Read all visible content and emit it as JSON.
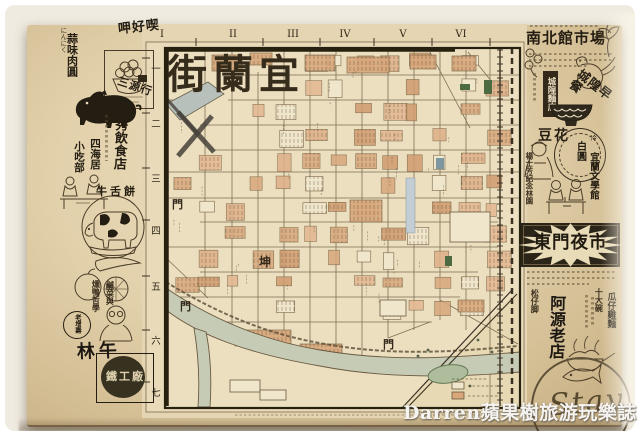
{
  "photo": {
    "watermark": "Darren蘋果樹旅游玩樂誌"
  },
  "map": {
    "title": "宜蘭街",
    "title_display": "街蘭宜",
    "grid_columns": [
      "I",
      "II",
      "III",
      "IV",
      "V",
      "VI"
    ],
    "grid_rows": [
      "一",
      "二",
      "三",
      "四",
      "五",
      "六",
      "七"
    ],
    "gate_labels": [
      "門",
      "門",
      "坤",
      "門"
    ],
    "ink_color": "#3b3122",
    "block_color": "#d9a77c",
    "river_color": "#c6cbb6"
  },
  "left_ads": {
    "shop_logo": "呷好喫",
    "garlic_note": "にんにく",
    "garlic_product": "蒜味肉圓",
    "pig_shop": "三源行",
    "restaurant": "一秀飲食店",
    "snack_col_right": "四海居",
    "snack_col_left": "小吃部",
    "pastry": "牛舌餅",
    "pickle_line1": "鹹菜與",
    "pickle_line2": "燻鴨哲學",
    "stamp": "老增壽",
    "gong_name": "林午",
    "gong_factory": "鐵工廠"
  },
  "right_ads": {
    "market": "南北館市場",
    "breakfast": "城隍早餐",
    "noodle_label": "城隍麵店",
    "tofu": "豆花",
    "ice_circle": "白圓",
    "ice_small": "冷",
    "memorial": "楊士芳紀念林園",
    "literature": "宜蘭文學館",
    "night_market": "東門夜市",
    "bowl_count": "十大碗",
    "dish": "瓜仔雞麵",
    "place": "松仔脚",
    "old_shop": "阿源老店",
    "stay": "Stay"
  }
}
